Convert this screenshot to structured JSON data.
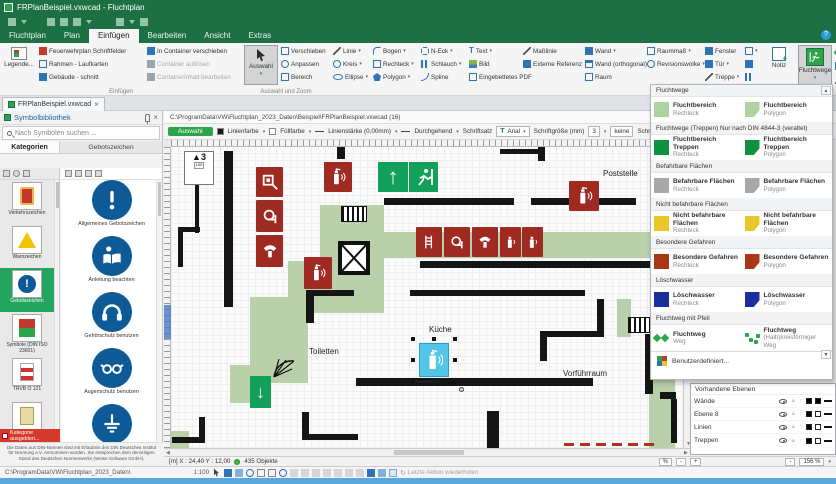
{
  "window": {
    "title": "FRPlanBeispiel.vxwcad - Fluchtplan"
  },
  "tabs": [
    "Fluchtplan",
    "Plan",
    "Einfügen",
    "Bearbeiten",
    "Ansicht",
    "Extras"
  ],
  "ribbon": {
    "legende": "Legende...",
    "einfuegen": [
      "Feuerwehrplan  Schriftfelder",
      "Rahmen - Laufkarten",
      "Gebäude - schnitt"
    ],
    "container": [
      "In Container verschieben",
      "Container auflösen",
      "Containerinhalt bearbeiten"
    ],
    "grp_einfuegen": "Einfügen",
    "auswahl": "Auswahl",
    "auswahl_tools": [
      "Verschieben",
      "Anpassen",
      "Bereich"
    ],
    "grp_auswahl": "Auswahl und Zoom",
    "draw1": [
      "Linie",
      "Kreis",
      "Ellipse"
    ],
    "draw2": [
      "Bogen",
      "Rechteck",
      "Polygon"
    ],
    "draw3": [
      "N-Eck",
      "Schlauch",
      "Spline"
    ],
    "media": [
      "Text",
      "Bild",
      "Eingebettetes PDF"
    ],
    "refs": [
      "Maßlinie",
      "Externe Referenz"
    ],
    "obj1": [
      "Wand",
      "Wand (orthogonal)",
      "Raum"
    ],
    "obj2": [
      "Raummaß",
      "Revisionswolke"
    ],
    "obj3": [
      "Fenster",
      "Tür",
      "Treppe"
    ],
    "grp_objekte": "Objekte",
    "notiz": "Notiz",
    "fluchtwege": "Fluchtwege"
  },
  "doc_tab": "FRPlanBeispiel.vxwcad",
  "sidebar": {
    "title": "Symbolbibliothek",
    "search": "Nach Symbolen suchen ...",
    "col_categories": "Kategorien",
    "col_symbols": "Gebotszeichen",
    "categories": [
      "Verkehrszeichen",
      "Warnzeichen",
      "Gebotszeichen",
      "Symbole (DIN ISO 23601)",
      "TRVB O 121",
      "Gebäudebeschilderung",
      "Verbotszeichen"
    ],
    "hide_category": "Kategorie ausgeblen...",
    "symbols": [
      "Allgemeines Gebotszeichen",
      "Anleitung beachten",
      "Gehörschutz benutzen",
      "Augenschutz benutzen",
      "Vor Benutzung erden"
    ],
    "disclaimer": "Die Daten aus DIN-Normen sind mit Erlaubnis des DIN Deutsches Institut für Normung e.V. entnommen worden. Sie entsprechen dem derzeitigen Stand des Deutschen Normenwerks (Weise Software GmbH)."
  },
  "canvas": {
    "path": "C:\\ProgramData\\VW\\Fluchtplan_2023_Daten\\Beispiel\\FRPlanBeispiel.vxwcad (16)",
    "toolbar": {
      "auswahl": "Auswahl",
      "linienfarbe": "Linienfarbe",
      "fuellfarbe": "Füllfarbe",
      "linienstaerke": "Linienstärke (0,00mm)",
      "linienart": "Durchgehend",
      "schriftsatz": "Schriftsatz",
      "font": "Arial",
      "schriftgroesse": "Schriftgröße (mm)",
      "size": "3",
      "schraffur": "keine",
      "schraffur_label": "Schraf"
    },
    "marker": {
      "size": "3",
      "scale": "100"
    },
    "rooms": {
      "poststelle": "Poststelle",
      "toiletten": "Toiletten",
      "kueche": "Küche",
      "vorfuehrraum": "Vorführraum"
    },
    "selected_symbol": "Feuerlöscher",
    "status": {
      "coords": "[m] X : 24,40 Y : 12,00",
      "objects": "435 Objekte",
      "zoom": "156 %",
      "percent_btn": "%",
      "minus": "-",
      "plus": "+"
    }
  },
  "menu": {
    "sections": [
      {
        "header": "Fluchtwege",
        "items": [
          {
            "title": "Fluchtbereich",
            "sub": "Rechteck"
          },
          {
            "title": "Fluchtbereich",
            "sub": "Polygon"
          }
        ]
      },
      {
        "header": "Fluchtwege (Treppen) Nur nach  DIN 4844-3 (veraltet)",
        "items": [
          {
            "title": "Fluchtbereich Treppen",
            "sub": "Rechteck"
          },
          {
            "title": "Fluchtbereich Treppen",
            "sub": "Polygon"
          }
        ]
      },
      {
        "header": "Befahrbare Flächen",
        "items": [
          {
            "title": "Befahrbare Flächen",
            "sub": "Rechteck"
          },
          {
            "title": "Befahrbare Flächen",
            "sub": "Polygon"
          }
        ]
      },
      {
        "header": "Nicht befahrbare Flächen",
        "items": [
          {
            "title": "Nicht befahrbare Flächen",
            "sub": "Rechteck"
          },
          {
            "title": "Nicht befahrbare Flächen",
            "sub": "Polygon"
          }
        ]
      },
      {
        "header": "Besondere Gefahren",
        "items": [
          {
            "title": "Besondere Gefahren",
            "sub": "Rechteck"
          },
          {
            "title": "Besondere Gefahren",
            "sub": "Polygon"
          }
        ]
      },
      {
        "header": "Löschwasser",
        "items": [
          {
            "title": "Löschwasser",
            "sub": "Rechteck"
          },
          {
            "title": "Löschwasser",
            "sub": "Polygon"
          }
        ]
      },
      {
        "header": "Fluchtweg mit Pfeil",
        "items": [
          {
            "title": "Fluchtweg",
            "sub": "Weg"
          },
          {
            "title": "Fluchtweg",
            "sub": "(Halb)kreisförmiger Weg"
          }
        ]
      }
    ],
    "footer": "Benutzerdefiniert..."
  },
  "layers": {
    "header": "Vorhandene Ebenen",
    "rows": [
      {
        "name": "Wände",
        "fill": "#000000"
      },
      {
        "name": "Ebene 8",
        "fill": "#ffffff"
      },
      {
        "name": "Linien",
        "fill": "#ffffff"
      },
      {
        "name": "Treppen",
        "fill": "#ffffff"
      }
    ]
  },
  "statusbar": {
    "path": "C:\\ProgramData\\VW\\Fluchtplan_2023_Daten\\",
    "scale": "1:100",
    "redo": "Letzte Aktion wiederholen"
  },
  "colors": {
    "titlebar_green": "#1d7044",
    "accent_green": "#2fa24c",
    "route_green": "#b9d0aa",
    "safety_red": "#9e2a21",
    "exit_green": "#12a05a",
    "selection_cyan": "#53c6e8",
    "menu_light_green": "#aed3a0",
    "menu_dark_green": "#0f9140",
    "menu_gray": "#a8a8a8",
    "menu_yellow": "#eac728",
    "menu_dark_red": "#a93614",
    "menu_dark_blue": "#1b2ea0"
  }
}
